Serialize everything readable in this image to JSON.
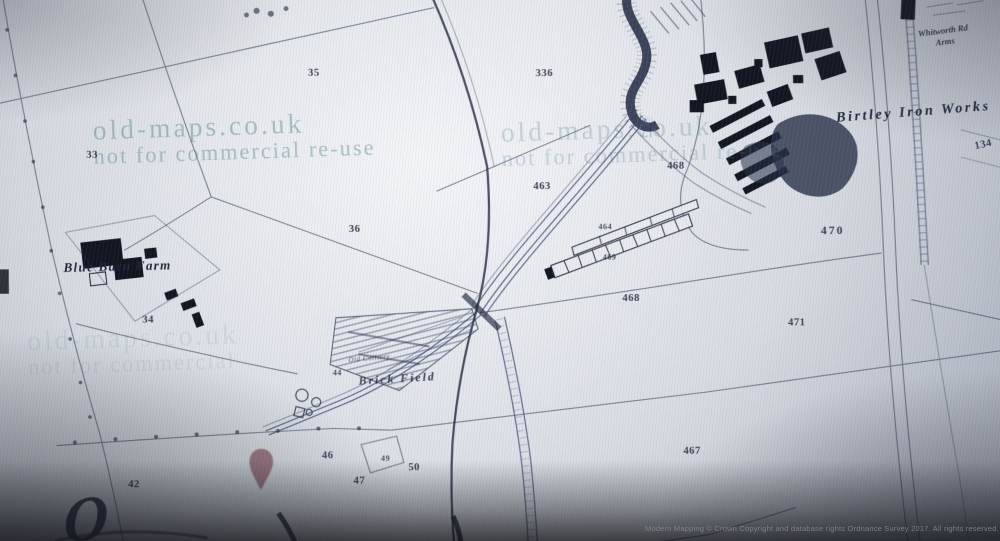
{
  "watermark": {
    "line1": "old-maps.co.uk",
    "line2": "not for commercial re-use"
  },
  "labels": {
    "blue_barn_farm": "Blue Barn Farm",
    "birtley_iron_works": "Birtley Iron Works",
    "brick_field": "Brick Field",
    "old_colliery": "Old Colliery",
    "pub_line1": "Whitworth Rd",
    "pub_line2": "Arms",
    "script_letter": "O"
  },
  "parcels": [
    {
      "label": "35"
    },
    {
      "label": "33"
    },
    {
      "label": "336"
    },
    {
      "label": "463"
    },
    {
      "label": "468"
    },
    {
      "label": "36"
    },
    {
      "label": "34"
    },
    {
      "label": "464"
    },
    {
      "label": "469"
    },
    {
      "label": "468"
    },
    {
      "label": "470"
    },
    {
      "label": "471"
    },
    {
      "label": "134"
    },
    {
      "label": "467"
    },
    {
      "label": "42"
    },
    {
      "label": "44"
    },
    {
      "label": "46"
    },
    {
      "label": "47"
    },
    {
      "label": "49"
    },
    {
      "label": "50"
    }
  ],
  "marker": {
    "color": "#8c5f6d"
  },
  "footer": {
    "copyright": "Modern Mapping © Crown Copyright and database rights Ordnance Survey 2017. All rights reserved."
  },
  "colors": {
    "ink": "#2b3350",
    "buildings": "#10151f",
    "railway": "#3c4a70",
    "watermark": "#4a808a"
  }
}
